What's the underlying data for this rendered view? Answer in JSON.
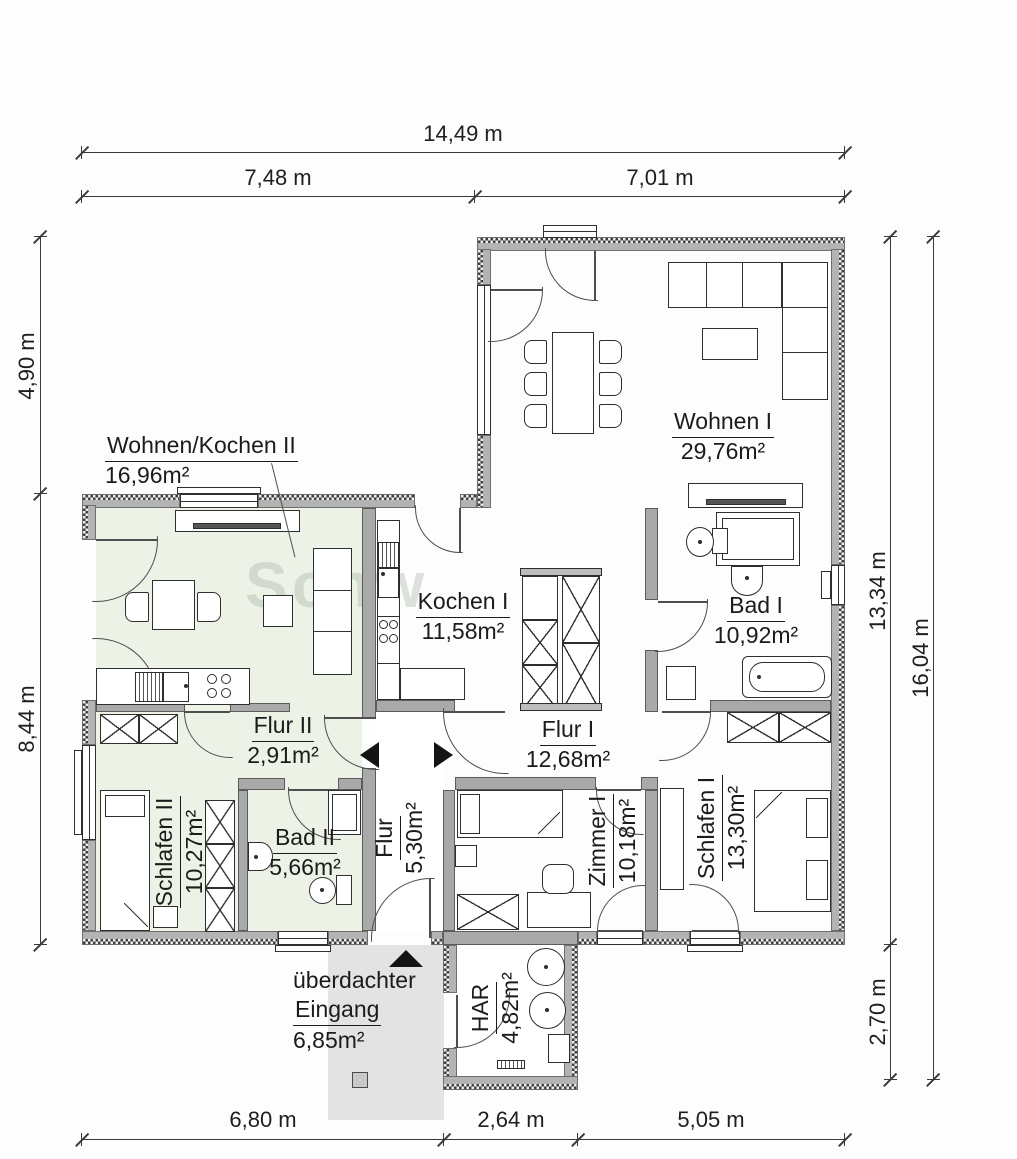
{
  "plan": {
    "watermark": "Schw",
    "rooms": {
      "wohnen1": {
        "name": "Wohnen I",
        "area": "29,76m²"
      },
      "kochen1": {
        "name": "Kochen I",
        "area": "11,58m²"
      },
      "flur1": {
        "name": "Flur I",
        "area": "12,68m²"
      },
      "bad1": {
        "name": "Bad I",
        "area": "10,92m²"
      },
      "schlafen1": {
        "name": "Schlafen I",
        "area": "13,30m²"
      },
      "zimmer1": {
        "name": "Zimmer I",
        "area": "10,18m²"
      },
      "flur": {
        "name": "Flur",
        "area": "5,30m²"
      },
      "har": {
        "name": "HAR",
        "area": "4,82m²"
      },
      "wohnen_kochen2": {
        "name": "Wohnen/Kochen II",
        "area": "16,96m²"
      },
      "flur2": {
        "name": "Flur II",
        "area": "2,91m²"
      },
      "bad2": {
        "name": "Bad II",
        "area": "5,66m²"
      },
      "schlafen2": {
        "name": "Schlafen II",
        "area": "10,27m²"
      },
      "eingang": {
        "name_line1": "überdachter",
        "name_line2": "Eingang",
        "area": "6,85m²"
      }
    },
    "dimensions": {
      "top_total": "14,49 m",
      "top_left": "7,48 m",
      "top_right": "7,01 m",
      "left_upper": "4,90 m",
      "left_lower": "8,44 m",
      "right_main": "13,34 m",
      "right_lower": "2,70 m",
      "right_total": "16,04 m",
      "bottom_left": "6,80 m",
      "bottom_center": "2,64 m",
      "bottom_right": "5,05 m"
    },
    "colors": {
      "apartment2_tint": "#edf2e7",
      "entrance_gray": "#e3e3e3",
      "wall_fill": "#b3b3b3"
    }
  }
}
